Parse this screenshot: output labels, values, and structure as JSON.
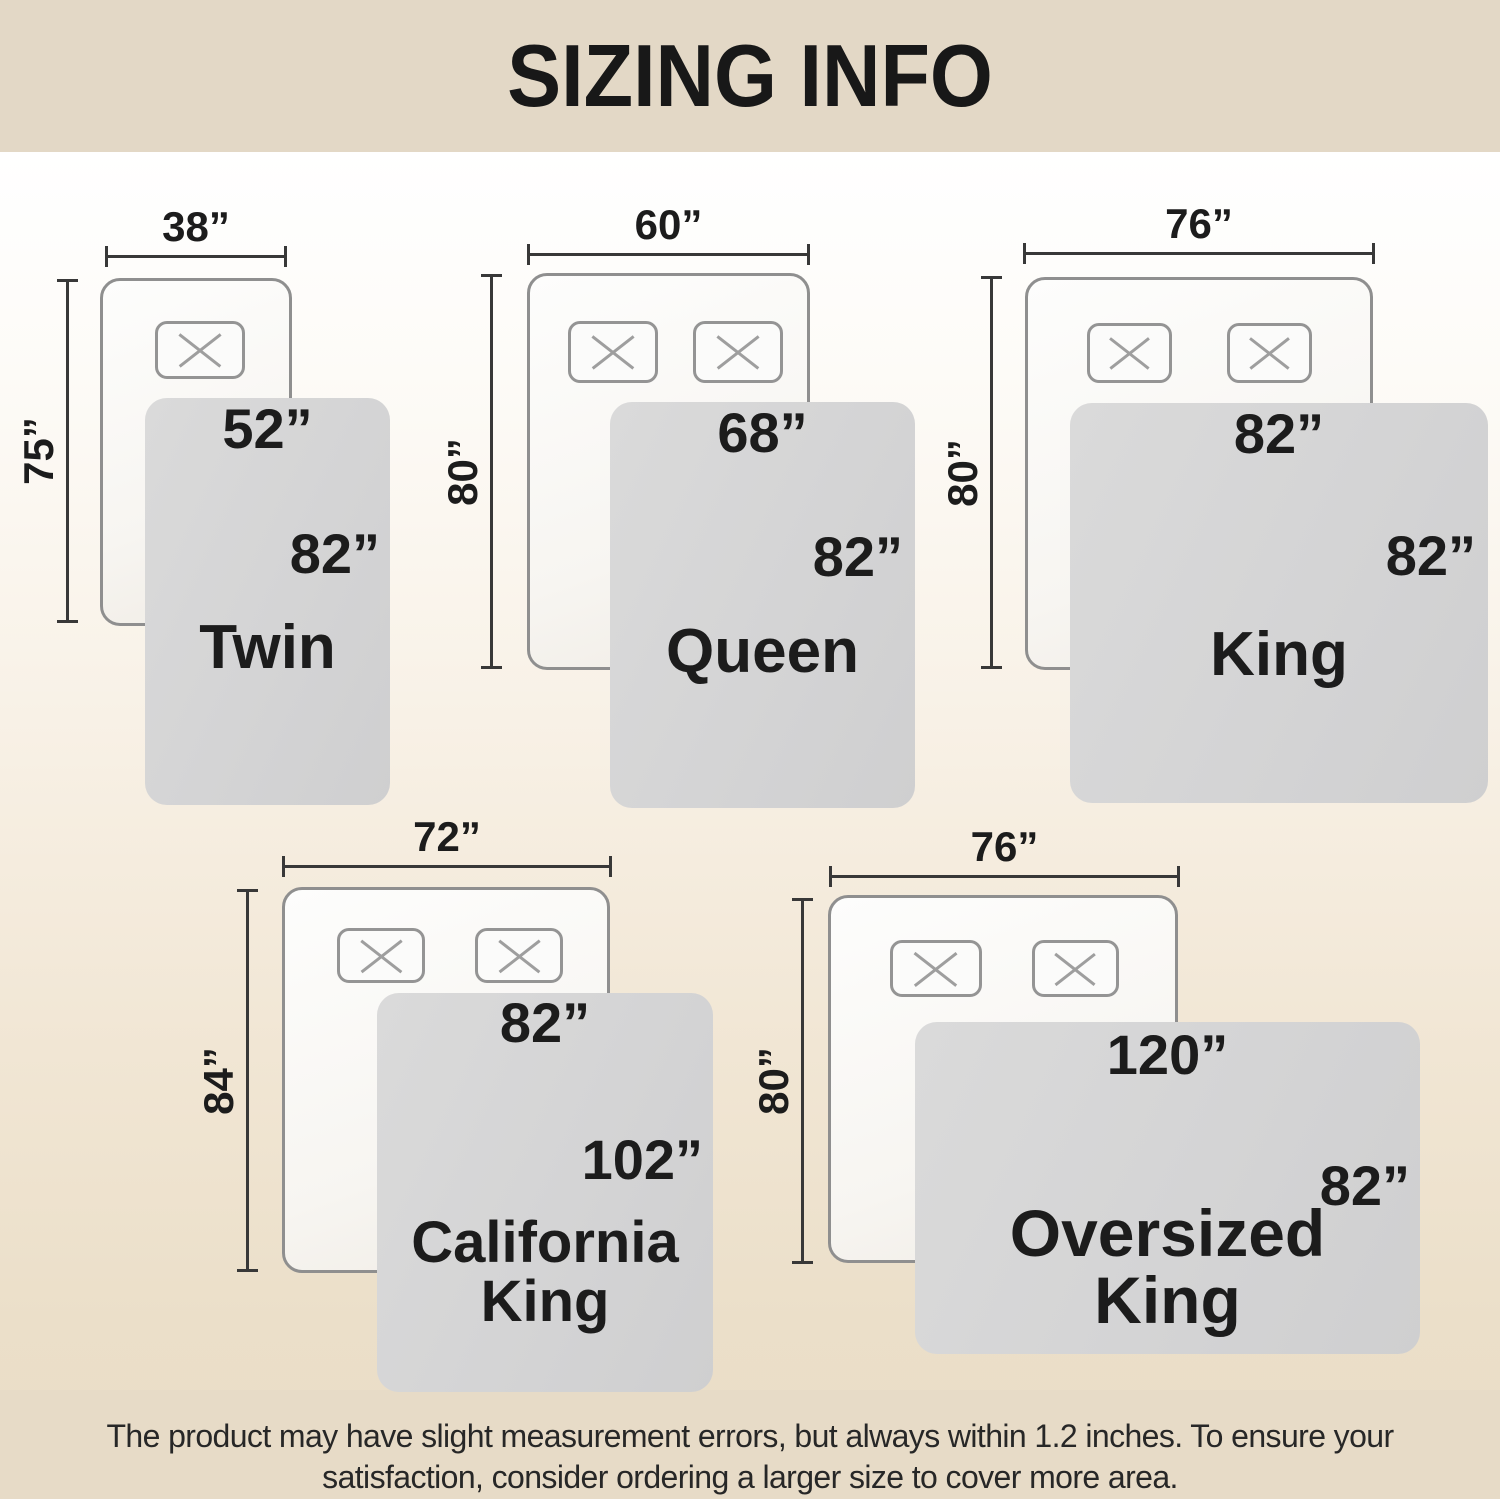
{
  "header": {
    "title": "SIZING INFO"
  },
  "footer": {
    "line1": "The product may have slight measurement errors, but always within 1.2 inches. To ensure your",
    "line2": "satisfaction, consider ordering a larger size to cover more area."
  },
  "colors": {
    "header_bg": "#e3d8c6",
    "footer_bg": "#e7dbc7",
    "blanket_fill": "#d4d4d5",
    "mattress_border": "#8f8f8f",
    "dimension_line": "#383838",
    "text": "#1c1c1c"
  },
  "sizes": [
    {
      "name": "Twin",
      "name_line1": "Twin",
      "pillow_count": 1,
      "mattress": {
        "width_in": 38,
        "length_in": 75,
        "width_label": "38”",
        "length_label": "75”"
      },
      "blanket": {
        "width_in": 52,
        "length_in": 82,
        "width_label": "52”",
        "length_label": "82”"
      }
    },
    {
      "name": "Queen",
      "name_line1": "Queen",
      "pillow_count": 2,
      "mattress": {
        "width_in": 60,
        "length_in": 80,
        "width_label": "60”",
        "length_label": "80”"
      },
      "blanket": {
        "width_in": 68,
        "length_in": 82,
        "width_label": "68”",
        "length_label": "82”"
      }
    },
    {
      "name": "King",
      "name_line1": "King",
      "pillow_count": 2,
      "mattress": {
        "width_in": 76,
        "length_in": 80,
        "width_label": "76”",
        "length_label": "80”"
      },
      "blanket": {
        "width_in": 82,
        "length_in": 82,
        "width_label": "82”",
        "length_label": "82”"
      }
    },
    {
      "name": "California King",
      "name_line1": "California",
      "name_line2": "King",
      "pillow_count": 2,
      "mattress": {
        "width_in": 72,
        "length_in": 84,
        "width_label": "72”",
        "length_label": "84”"
      },
      "blanket": {
        "width_in": 82,
        "length_in": 102,
        "width_label": "82”",
        "length_label": "102”"
      }
    },
    {
      "name": "Oversized King",
      "name_line1": "Oversized",
      "name_line2": "King",
      "pillow_count": 2,
      "mattress": {
        "width_in": 76,
        "length_in": 80,
        "width_label": "76”",
        "length_label": "80”"
      },
      "blanket": {
        "width_in": 120,
        "length_in": 82,
        "width_label": "120”",
        "length_label": "82”"
      }
    }
  ]
}
